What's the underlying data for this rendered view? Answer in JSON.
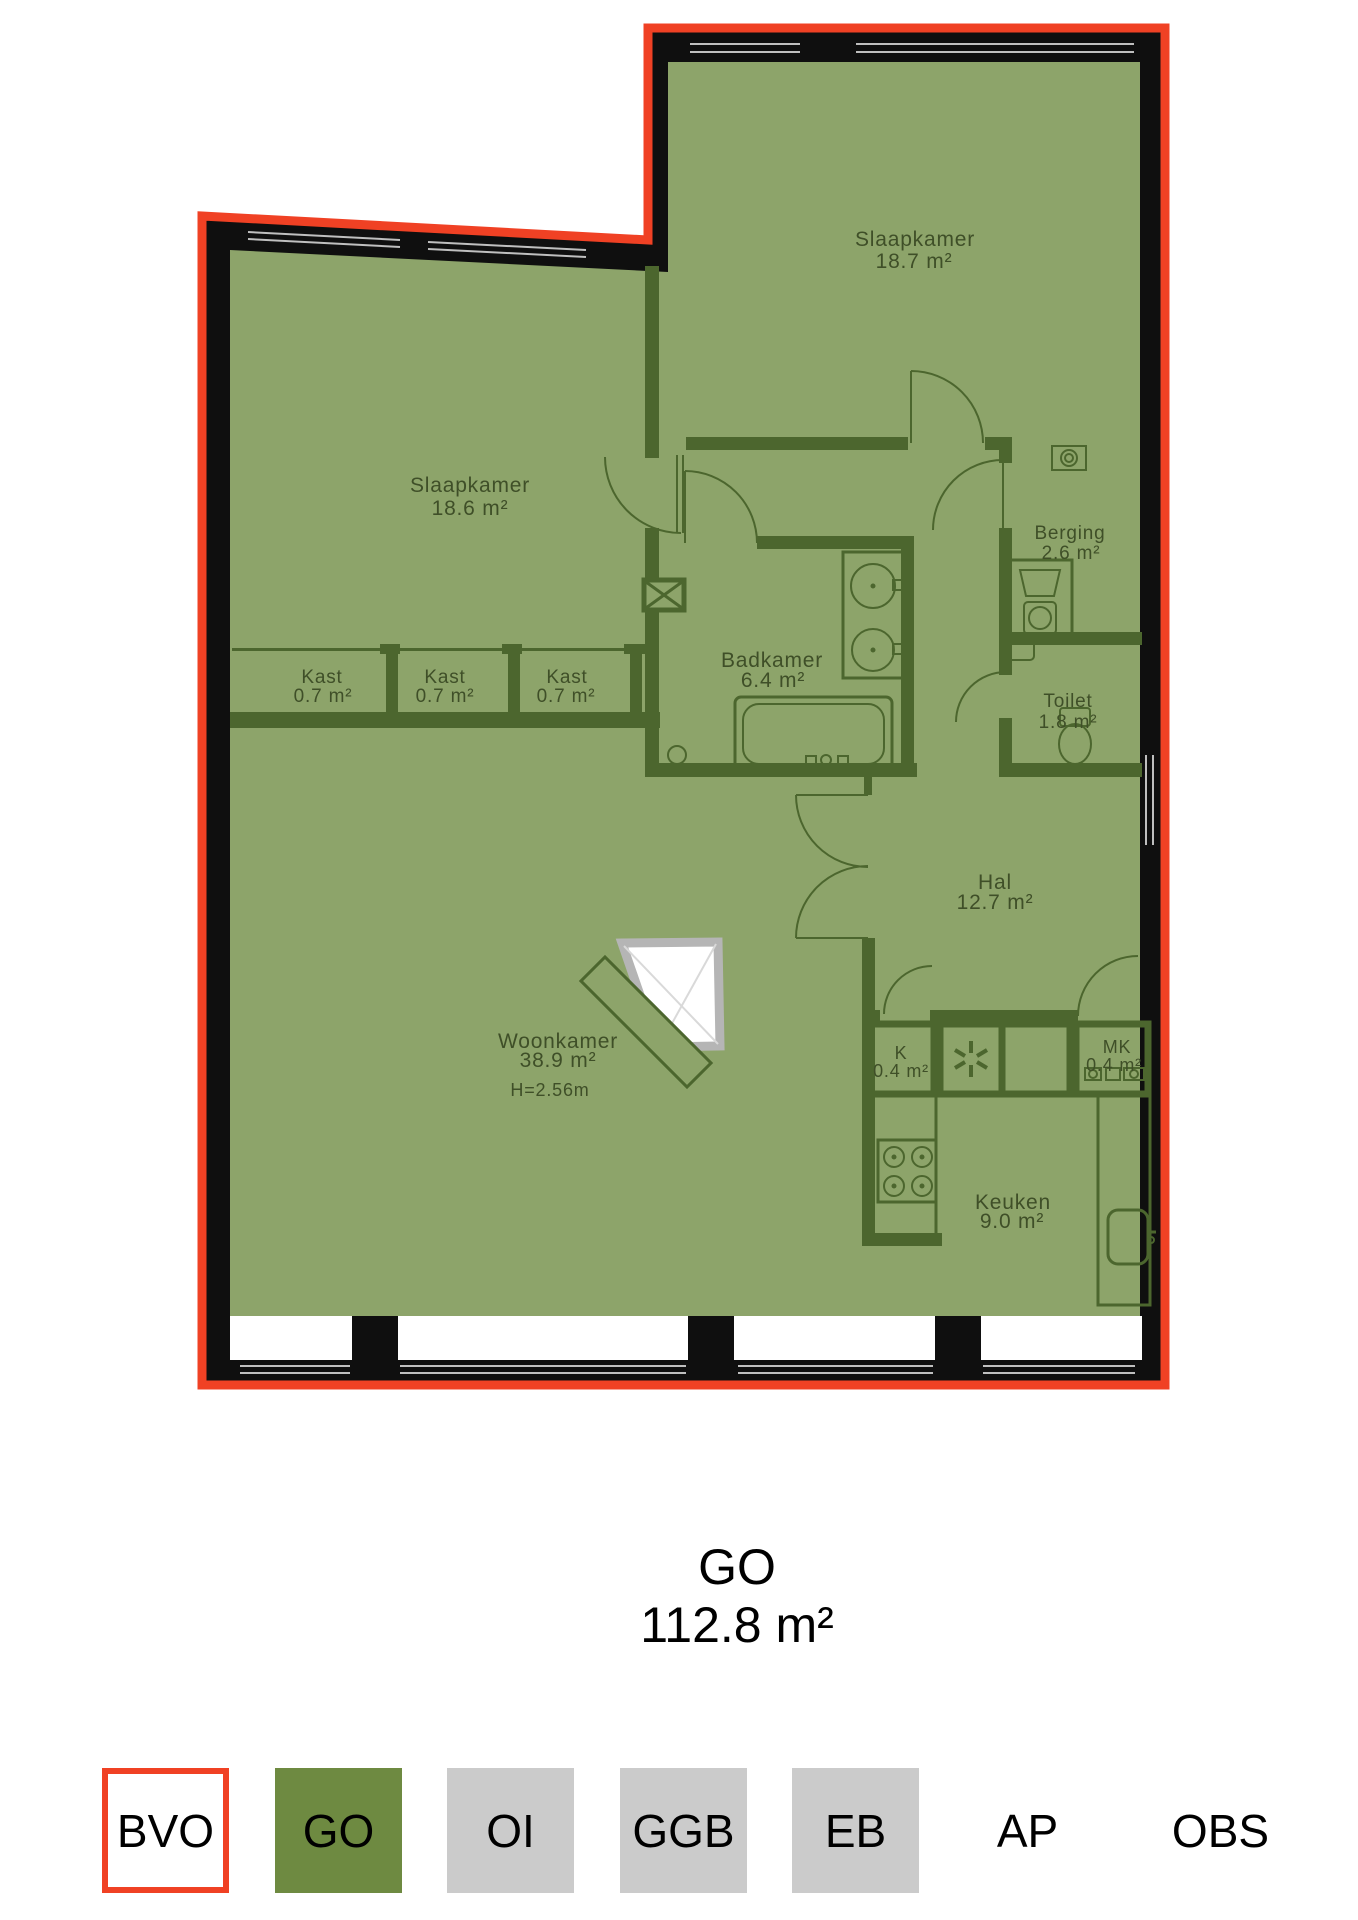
{
  "plan": {
    "rooms": [
      {
        "name": "Slaapkamer",
        "area": "18.6 m²"
      },
      {
        "name": "Slaapkamer",
        "area": "18.7 m²"
      },
      {
        "name": "Berging",
        "area": "2.6 m²"
      },
      {
        "name": "Badkamer",
        "area": "6.4 m²"
      },
      {
        "name": "Kast",
        "area": "0.7 m²"
      },
      {
        "name": "Kast",
        "area": "0.7 m²"
      },
      {
        "name": "Kast",
        "area": "0.7 m²"
      },
      {
        "name": "Toilet",
        "area": "1.8 m²"
      },
      {
        "name": "Hal",
        "area": "12.7 m²"
      },
      {
        "name": "Woonkamer",
        "area": "38.9 m²",
        "ceiling_height": "H=2.56m"
      },
      {
        "name": "K",
        "area": "0.4 m²"
      },
      {
        "name": "MK",
        "area": "0.4 m²"
      },
      {
        "name": "Keuken",
        "area": "9.0 m²"
      }
    ]
  },
  "summary": {
    "label": "GO",
    "value": "112.8 m²"
  },
  "legend": {
    "items": [
      {
        "label": "BVO",
        "style": "outlined",
        "fill": "#ffffff",
        "border": "#f04124"
      },
      {
        "label": "GO",
        "style": "filled",
        "fill": "#6e8a41"
      },
      {
        "label": "OI",
        "style": "filled",
        "fill": "#cbcbcb"
      },
      {
        "label": "GGB",
        "style": "filled",
        "fill": "#cbcbcb"
      },
      {
        "label": "EB",
        "style": "filled",
        "fill": "#cbcbcb"
      },
      {
        "label": "AP",
        "style": "plain"
      },
      {
        "label": "OBS",
        "style": "plain"
      }
    ]
  },
  "colors": {
    "floor_fill": "#8da46a",
    "outer_wall": "#0f0f0f",
    "boundary": "#f04124",
    "interior_wall": "#4c662e",
    "label_text": "#3f4f28"
  }
}
